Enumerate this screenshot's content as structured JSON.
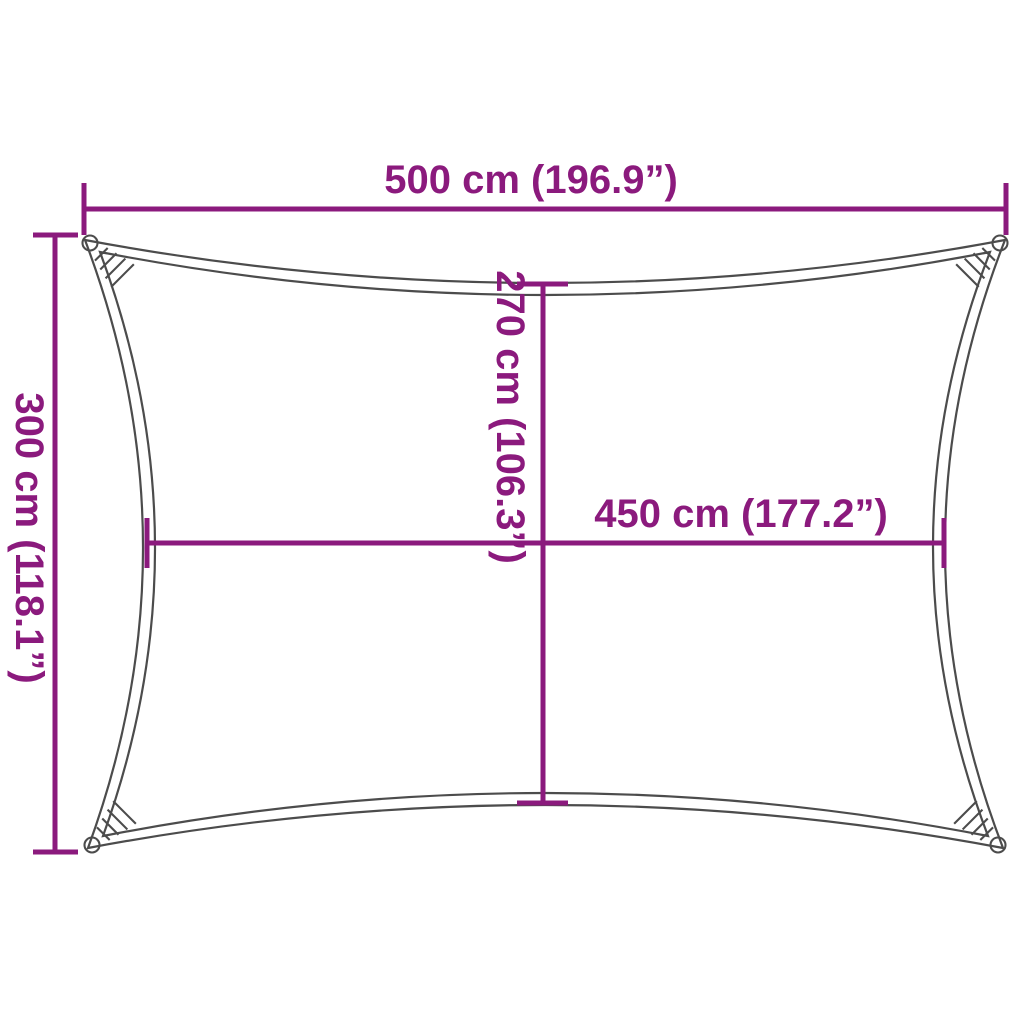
{
  "diagram": {
    "title": "shade-sail-dimension-diagram"
  },
  "labels": {
    "top_width": "500 cm (196.9”)",
    "left_height": "300 cm (118.1”)",
    "center_height": "270 cm (106.3”)",
    "center_width": "450 cm (177.2”)"
  },
  "colors": {
    "dimension": "#8B1A7D",
    "outline": "#4C4C4C",
    "background": "#FFFFFF"
  }
}
